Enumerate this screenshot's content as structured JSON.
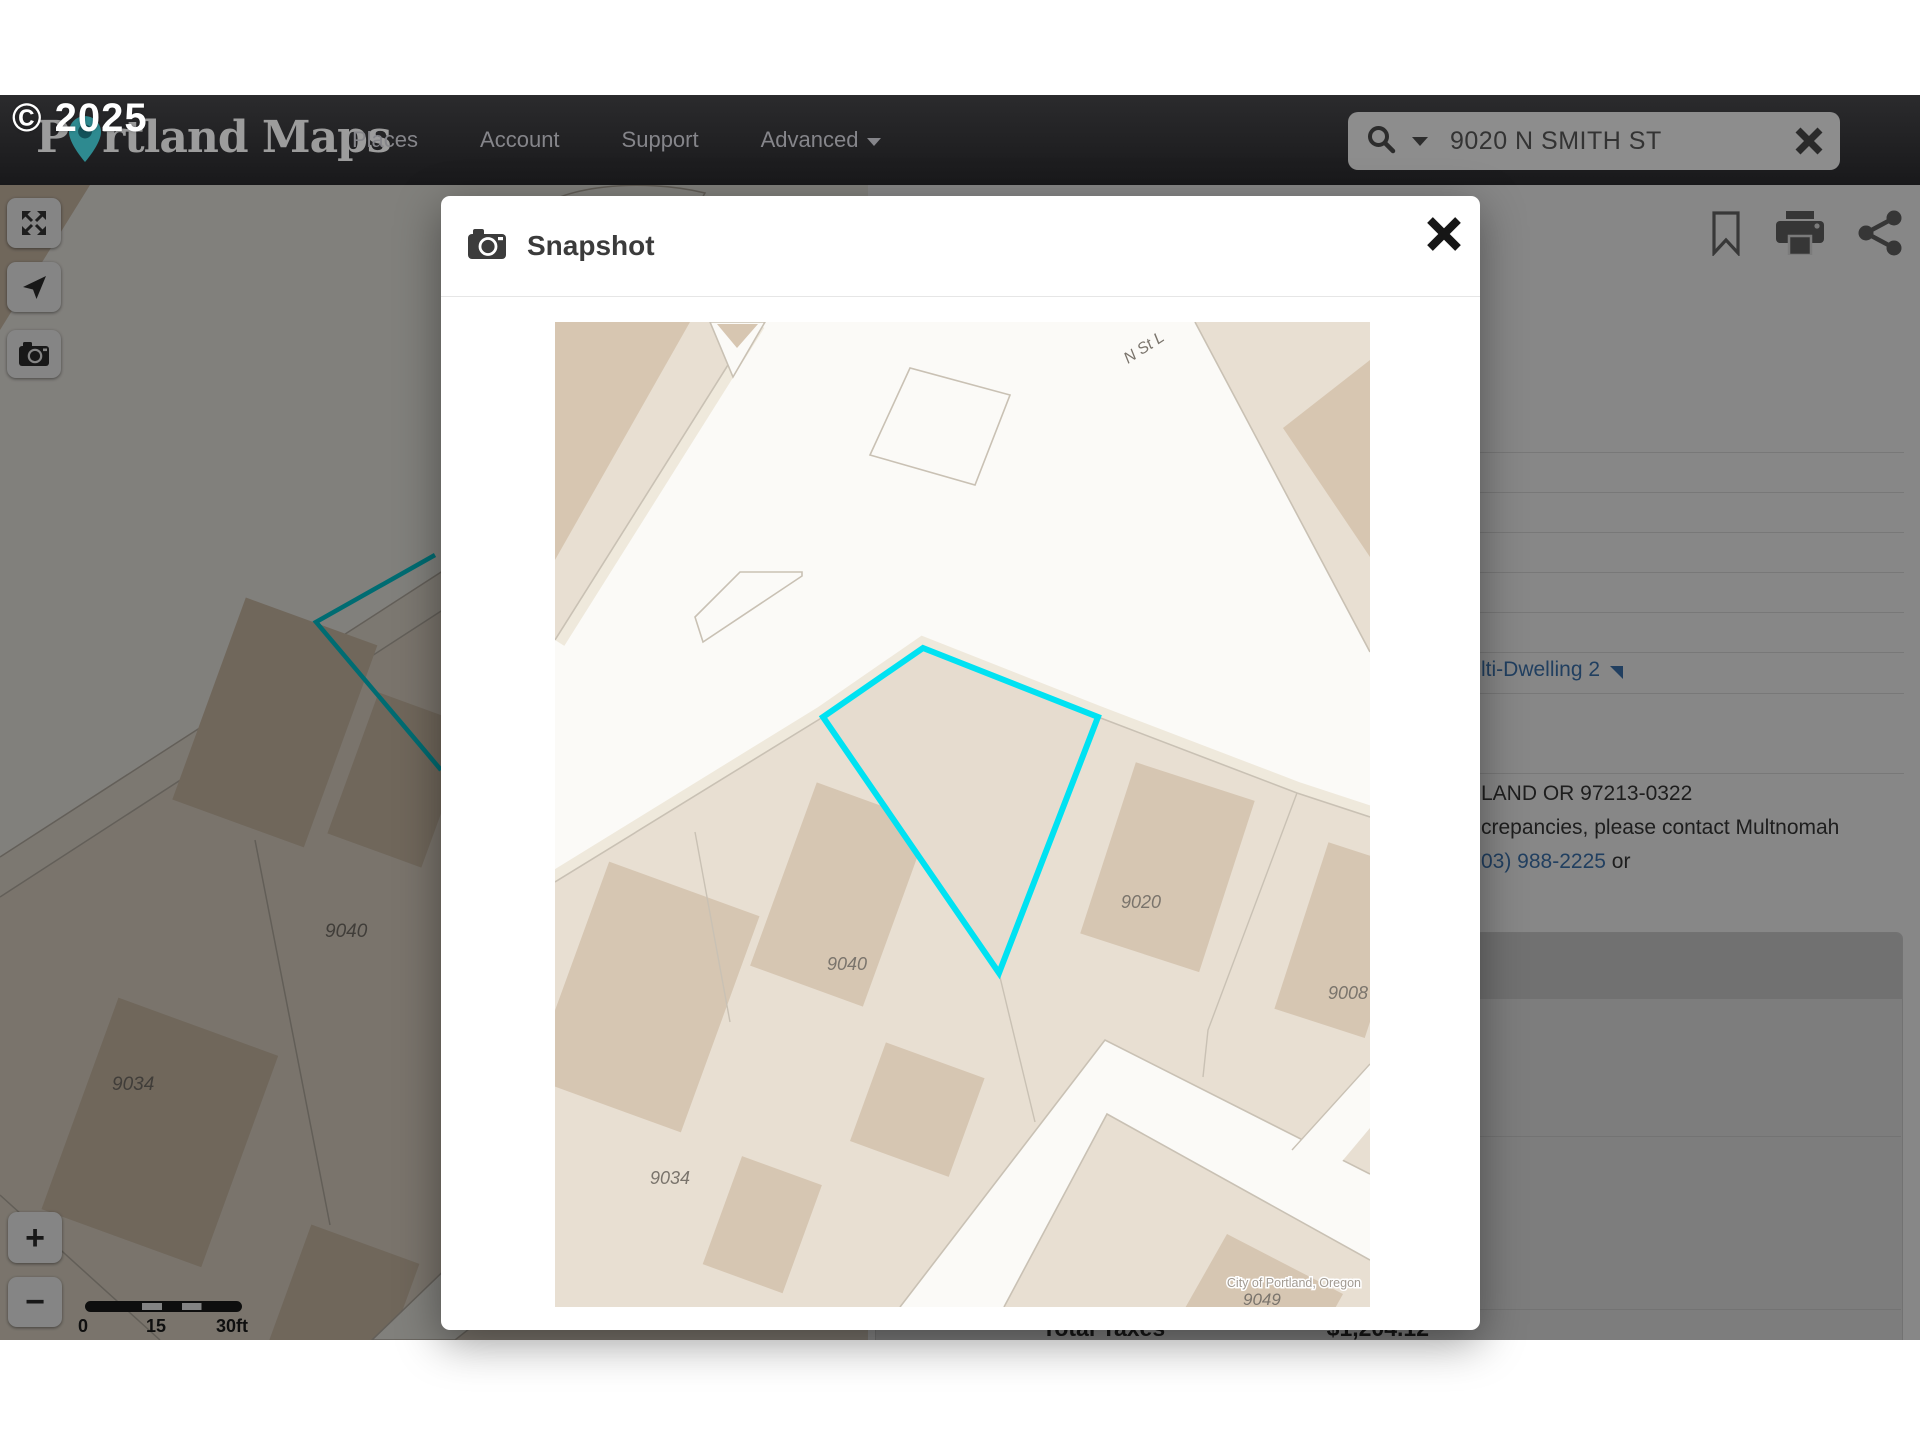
{
  "watermark": "© 2025",
  "nav": {
    "logo_pre": "P",
    "logo_post": "rtland Maps",
    "items": [
      {
        "label": "Places"
      },
      {
        "label": "Account"
      },
      {
        "label": "Support"
      },
      {
        "label": "Advanced"
      }
    ],
    "search": {
      "value": "9020 N SMITH ST"
    }
  },
  "map_controls": {
    "zoom_in": "+",
    "zoom_out": "−",
    "scale": {
      "start": "0",
      "mid": "15",
      "end": "30ft"
    }
  },
  "background_map": {
    "labels": {
      "l9040": "9040",
      "l9034": "9034",
      "l9049": "9049"
    }
  },
  "panel": {
    "zoning_link": "lti-Dwelling 2",
    "address_line": "LAND OR 97213-0322",
    "contact_line": "crepancies, please contact Multnomah",
    "phone_link": "03) 988-2225",
    "phone_suffix": "or",
    "total_taxes_label": "Total Taxes",
    "total_taxes_value": "$1,204.12"
  },
  "modal": {
    "title": "Snapshot",
    "attribution": "City of Portland, Oregon",
    "map_labels": {
      "street": "N St L",
      "p9020": "9020",
      "p9040": "9040",
      "p9034": "9034",
      "p9008": "9008",
      "p9049": "9049"
    }
  }
}
